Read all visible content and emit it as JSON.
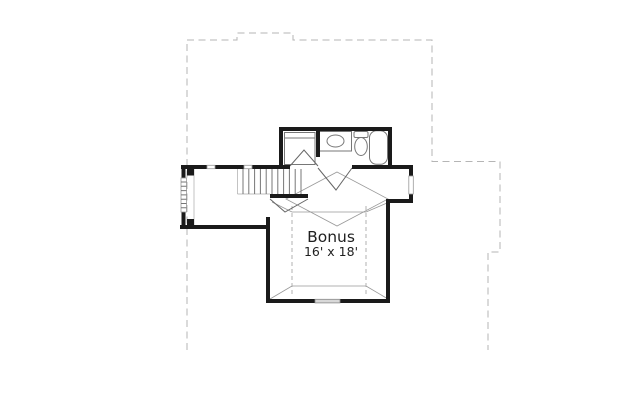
{
  "room": {
    "label": "Bonus",
    "dimensions": "16' x 18'"
  },
  "fixtures": {
    "bathroom": [
      "closet",
      "vanity-sink",
      "toilet",
      "bathtub"
    ],
    "circulation": [
      "staircase",
      "landing"
    ],
    "windows": [
      "landing-left-window",
      "hall-top-windows",
      "bay-right-window",
      "bonus-bottom-window"
    ]
  },
  "colors": {
    "wall": "#1a1a1a",
    "fixture_line": "#777777",
    "door_line": "#666666",
    "ceiling_line": "#999999",
    "knee_wall_dash": "#aaaaaa",
    "footprint_dash": "#b5b5b5",
    "window_fill": "#d8d8d8",
    "background": "#ffffff",
    "label_text": "#1f1f1f"
  }
}
